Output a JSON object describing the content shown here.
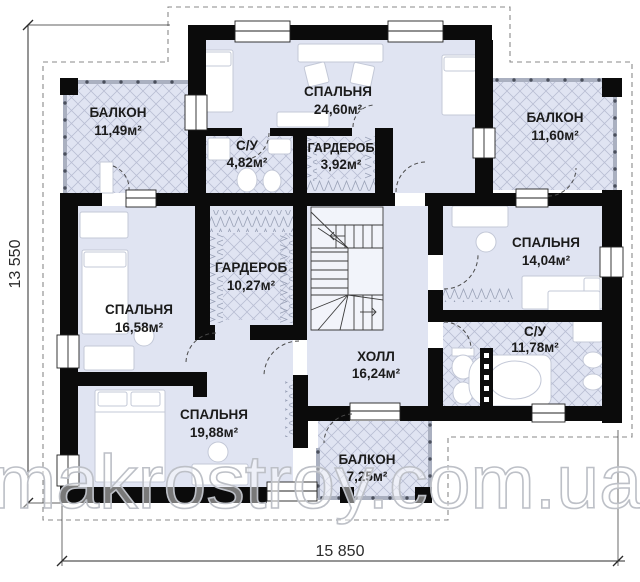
{
  "plan": {
    "type": "floor-plan",
    "rooms": [
      {
        "name": "БАЛКОН",
        "area": "11,49м²"
      },
      {
        "name": "СПАЛЬНЯ",
        "area": "24,60м²"
      },
      {
        "name": "БАЛКОН",
        "area": "11,60м²"
      },
      {
        "name": "С/У",
        "area": "4,82м²"
      },
      {
        "name": "ГАРДЕРОБ",
        "area": "3,92м²"
      },
      {
        "name": "ГАРДЕРОБ",
        "area": "10,27м²"
      },
      {
        "name": "СПАЛЬНЯ",
        "area": "14,04м²"
      },
      {
        "name": "СПАЛЬНЯ",
        "area": "16,58м²"
      },
      {
        "name": "С/У",
        "area": "11,78м²"
      },
      {
        "name": "ХОЛЛ",
        "area": "16,24м²"
      },
      {
        "name": "СПАЛЬНЯ",
        "area": "19,88м²"
      },
      {
        "name": "БАЛКОН",
        "area": "7,25м²"
      }
    ],
    "dimensions": {
      "height_label": "13 550",
      "width_label": "15 850"
    },
    "watermark": "makrostroy.com.ua",
    "colors": {
      "wall": "#0b0b0b",
      "room_fill": "#e0e4f2",
      "hatch_line": "#b9bed3",
      "zigzag_line": "#99a1b6",
      "furniture_stroke": "#c3c8d7",
      "dimension": "#2b2b2b",
      "roof_outline": "#8a8a8a",
      "watermark_stroke": "#bdc0c7"
    }
  }
}
